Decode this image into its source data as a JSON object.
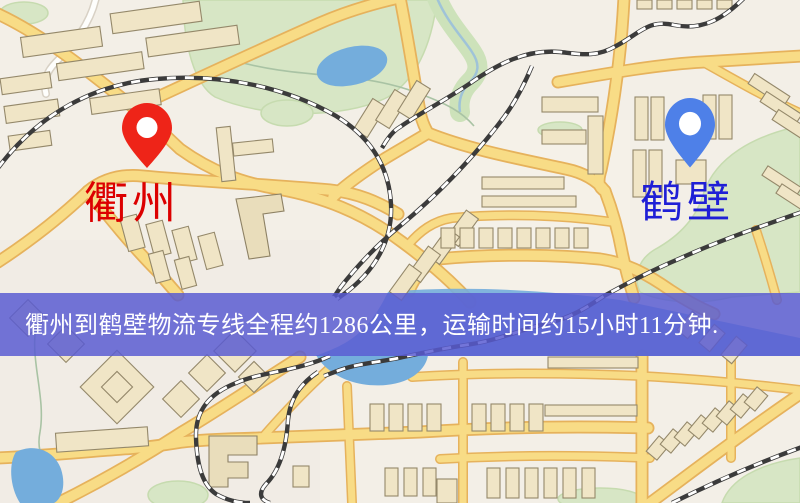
{
  "map": {
    "origin": {
      "name": "衢州",
      "pin_color": "#ee2418",
      "label_color": "#dc0000"
    },
    "destination": {
      "name": "鹤壁",
      "pin_color": "#4e80e8",
      "label_color": "#1f1fd6"
    },
    "banner": {
      "text": "衢州到鹤壁物流专线全程约1286公里，运输时间约15小时11分钟.",
      "bg_color": "rgba(88,90,210,0.84)",
      "text_color": "#ffffff"
    },
    "route": {
      "distance_km": 1286,
      "duration_hours": 15,
      "duration_minutes": 11
    }
  }
}
